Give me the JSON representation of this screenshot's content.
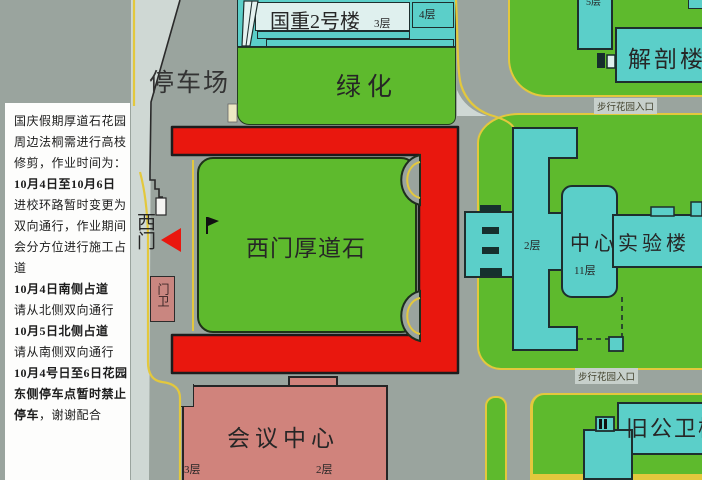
{
  "sidebar": {
    "lines": [
      [
        {
          "t": "国庆假期厚道石花园",
          "b": false
        }
      ],
      [
        {
          "t": "周边法桐需进行高枝",
          "b": false
        }
      ],
      [
        {
          "t": "修剪，作业时间为：",
          "b": false
        }
      ],
      [
        {
          "t": "10月4日至10月6日",
          "b": true
        }
      ],
      [
        {
          "t": "进校环路暂时变更为",
          "b": false
        }
      ],
      [
        {
          "t": "双向通行，作业期间",
          "b": false
        }
      ],
      [
        {
          "t": "会分方位进行施工占",
          "b": false
        }
      ],
      [
        {
          "t": "道",
          "b": false
        }
      ],
      [
        {
          "t": "10月4日南侧占道",
          "b": true
        }
      ],
      [
        {
          "t": "请从北侧双向通行",
          "b": false
        }
      ],
      [
        {
          "t": "10月5日北侧占道",
          "b": true
        }
      ],
      [
        {
          "t": "请从南侧双向通行",
          "b": false
        }
      ],
      [
        {
          "t": "10月4号日至6日花园",
          "b": true
        }
      ],
      [
        {
          "t": "东侧停车点暂时禁止",
          "b": true
        }
      ],
      [
        {
          "t": "停车",
          "b": true
        },
        {
          "t": "，谢谢配合",
          "b": false
        }
      ]
    ]
  },
  "map": {
    "labels": {
      "parking": "停车场",
      "guozhong": "国重2号楼",
      "guozhong_floor3": "3层",
      "guozhong_floor4": "4层",
      "lvhua": "绿化",
      "jiepou": "解剖楼",
      "jiepou_top_floor": "5层",
      "ximen": "西门",
      "menwei": "门卫",
      "houdaoshi": "西门厚道石",
      "zhongxin": "中心实验楼",
      "zhongxin_floor2": "2层",
      "zhongxin_floor11": "11层",
      "path_entrance_top": "步行花园入口",
      "path_entrance_bottom": "步行花园入口",
      "huiyi": "会议中心",
      "huiyi_floor3": "3层",
      "huiyi_floor2": "2层",
      "jiugongwei": "旧公卫楼"
    },
    "colors": {
      "road_gray": "#9aa49e",
      "sidewalk_gray": "#cfd8d4",
      "grass_green": "#5eba2d",
      "building_cyan": "#5bcfc9",
      "building_inner": "#dff0ee",
      "closure_red": "#e9170e",
      "conference_pink": "#d0837c",
      "gatehouse_pink": "#c98680",
      "curb_yellow": "#e3c83d",
      "outline_dark": "#1e2e2e",
      "panel_white": "#fdfdfc",
      "text_dark": "#262626"
    }
  }
}
